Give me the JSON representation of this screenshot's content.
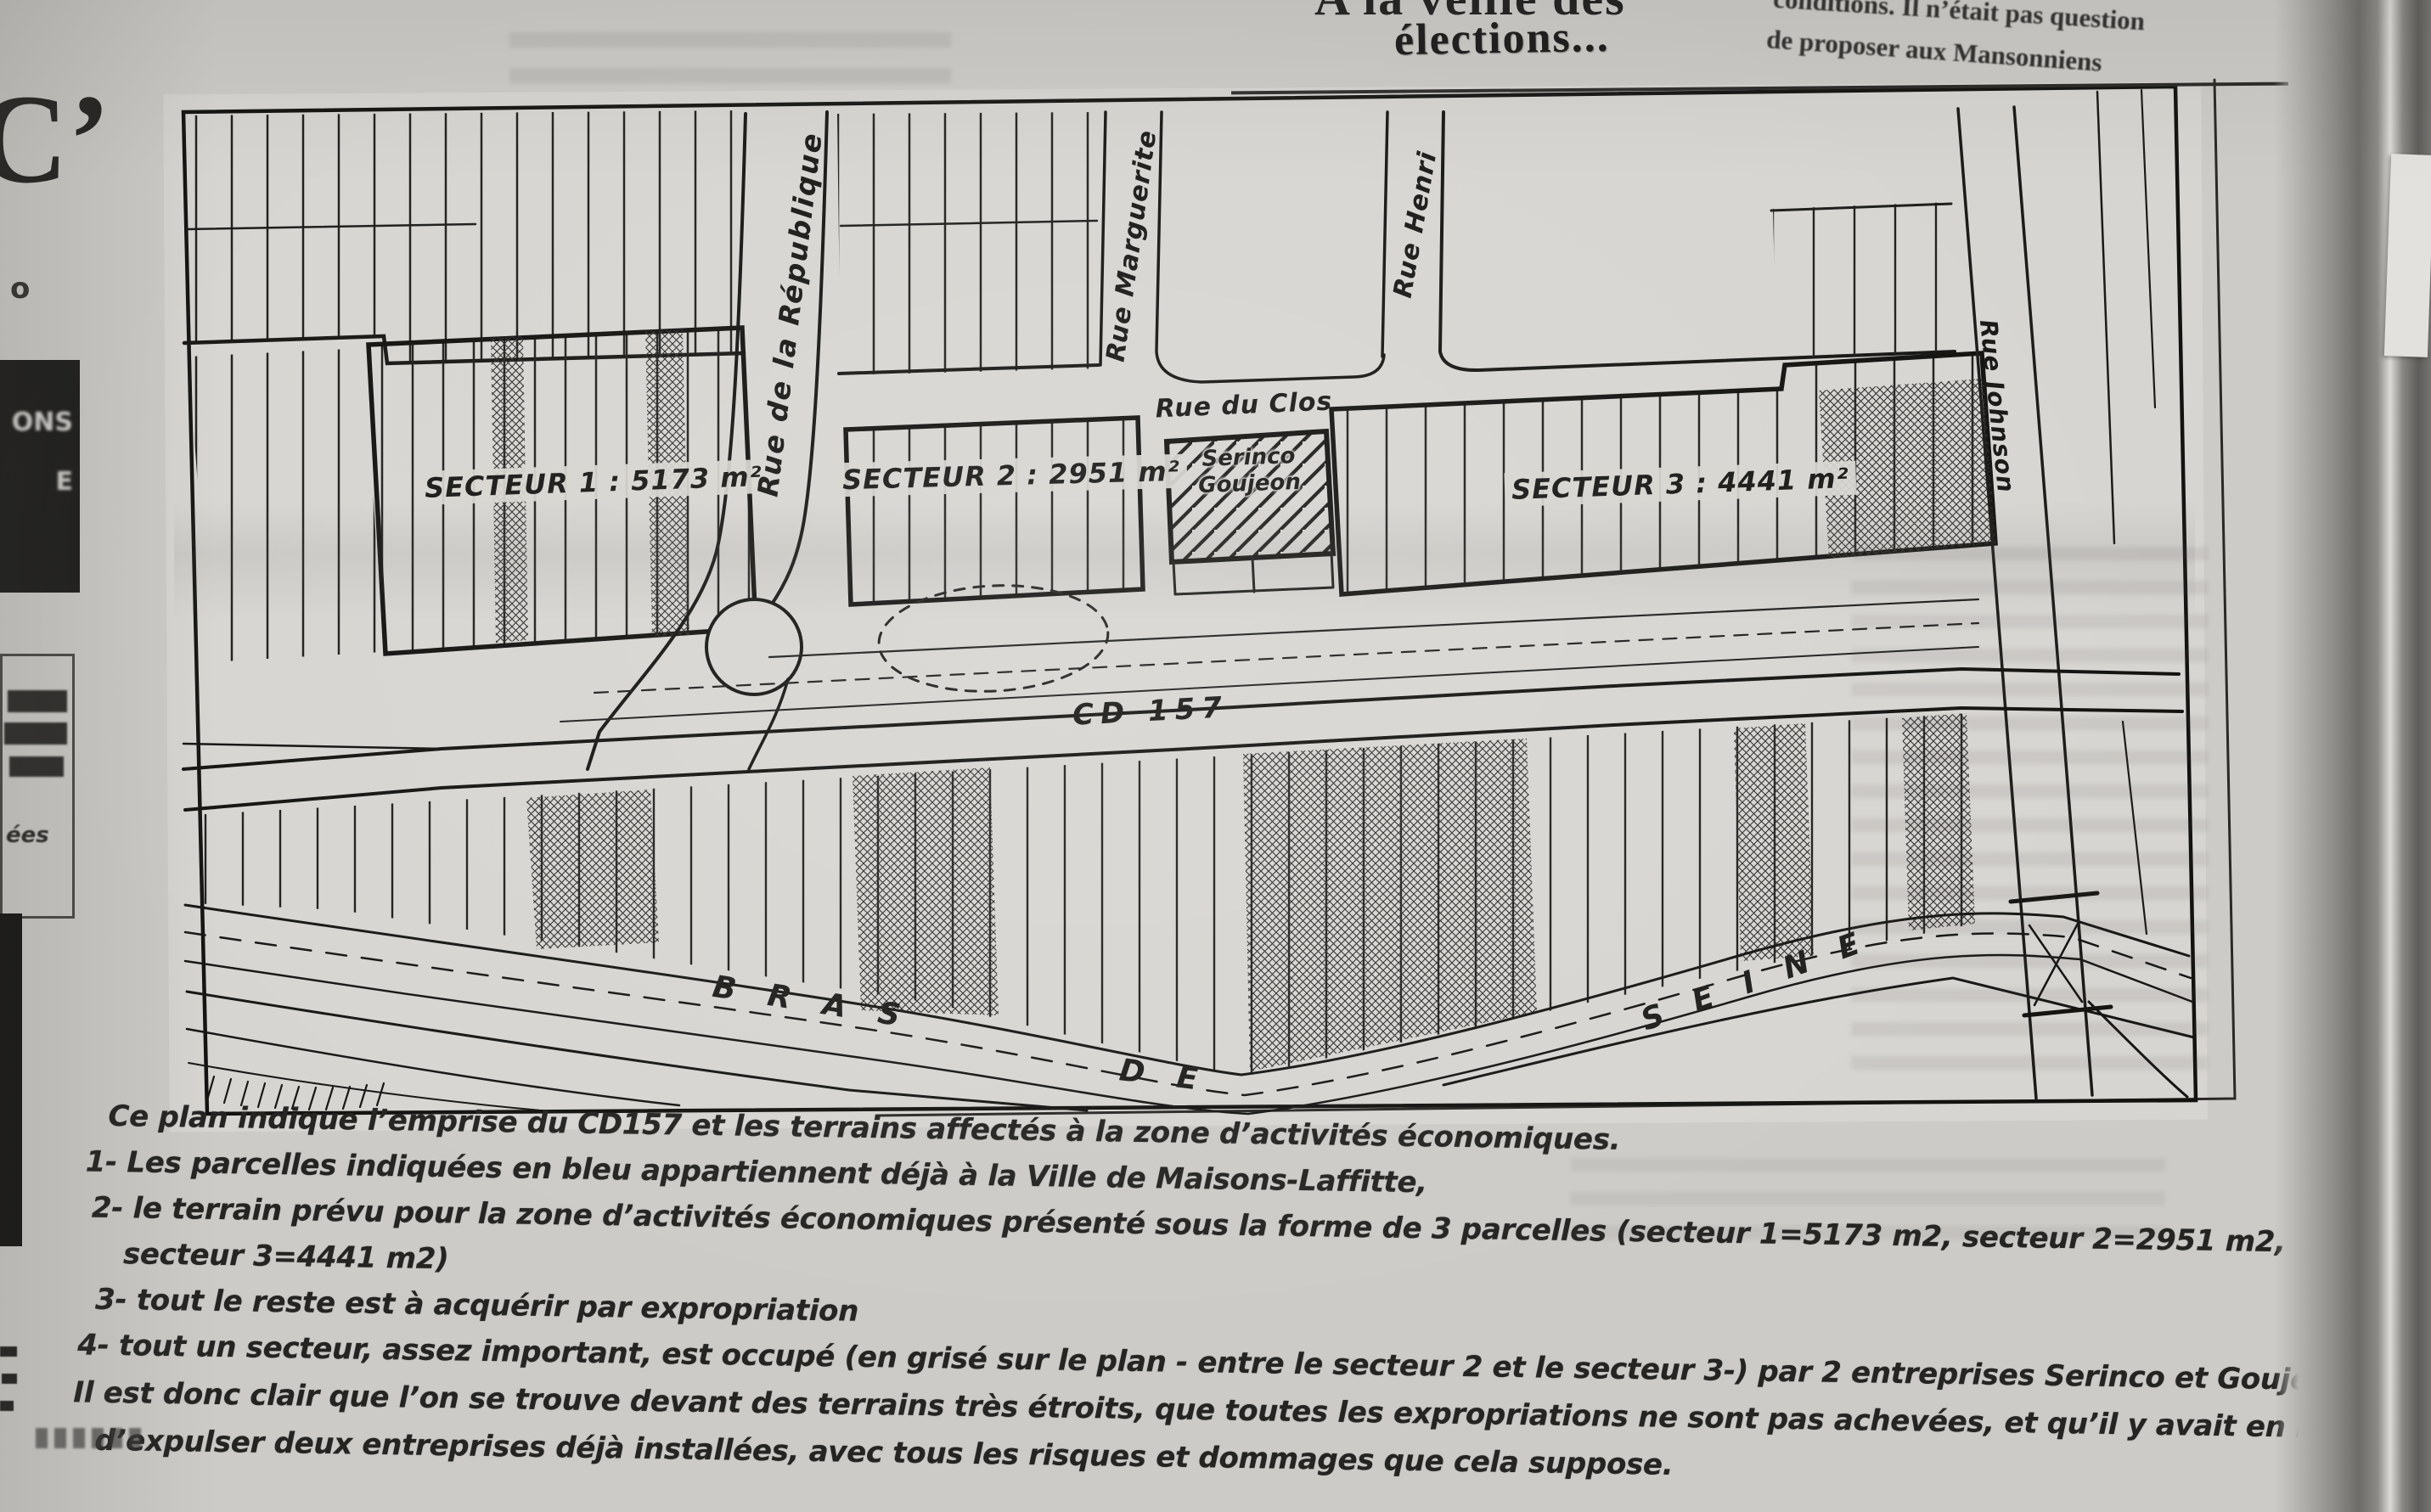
{
  "page": {
    "paper_color": "#d6d4d0",
    "ink_color": "#1c1c1c",
    "header": {
      "cropped_title_line": "A la veille des",
      "title": "élections...",
      "right_column": {
        "line1": "conditions. Il n’était pas question",
        "line2": "de proposer aux Mansonniens"
      }
    },
    "map": {
      "sectors": [
        {
          "label": "SECTEUR 1 : 5173 m²"
        },
        {
          "label": "SECTEUR 2 : 2951 m²"
        },
        {
          "label": "SECTEUR 3 : 4441 m²"
        }
      ],
      "company_box": {
        "line1": "Serinco",
        "line2": "Goujeon"
      },
      "streets": {
        "republique": "Rue de la République",
        "marguerite": "Rue Marguerite",
        "henri": "Rue Henri",
        "clos": "Rue du Clos",
        "johnson": "Rue Johnson",
        "cd157": "CD 157"
      },
      "river": {
        "word1": "BRAS",
        "word2": "DE",
        "word3": "SEINE"
      }
    },
    "caption": {
      "lines": [
        "Ce plan indique l’emprise du CD157  et les terrains affectés à la zone d’activités économiques.",
        "1- Les parcelles indiquées en bleu appartiennent déjà à la Ville de Maisons-Laffitte,",
        "2- le terrain prévu pour la zone d’activités économiques présenté sous la forme de 3 parcelles (secteur 1=5173 m2, secteur 2=2951 m2,",
        "secteur 3=4441 m2)",
        "3- tout le reste est à acquérir par expropriation",
        "4- tout un secteur, assez important, est occupé (en grisé sur le plan - entre le secteur 2 et le secteur 3-) par 2 entreprises Serinco et Goujeon.",
        "Il est donc clair que l’on se trouve devant des terrains très étroits, que toutes les expropriations ne sont pas achevées, et qu’il y avait en lieu",
        "d’expulser deux entreprises déjà installées, avec tous les risques et dommages que cela suppose."
      ]
    },
    "margins": {
      "left": {
        "partial_letter": "C’",
        "small_letter": "o",
        "black_box_line1": "ONS",
        "black_box_line2": "E",
        "box_fragment": "ées"
      }
    }
  }
}
